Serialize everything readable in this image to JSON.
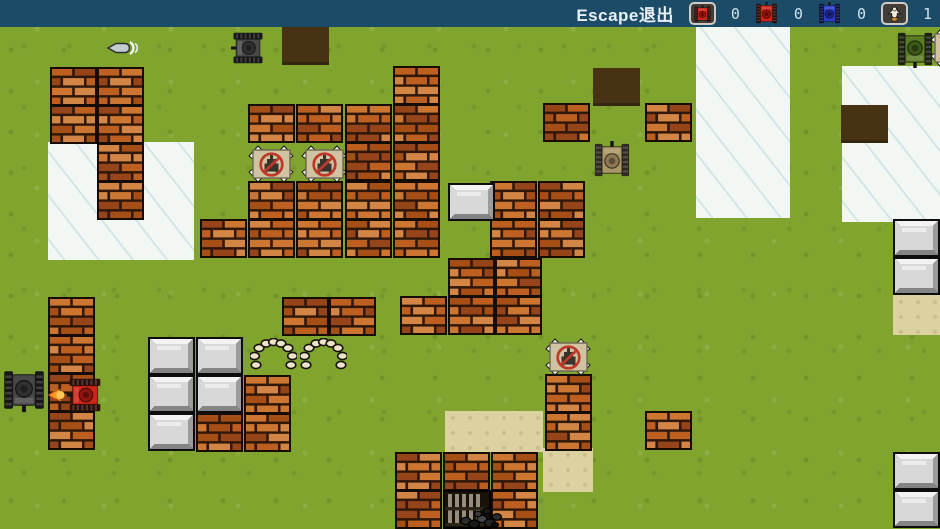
{
  "hud": {
    "escape_label": "Escape退出",
    "counts": [
      "0",
      "0",
      "0",
      "1"
    ],
    "icons": [
      "player-red-tank-icon",
      "red-tank-icon",
      "blue-tank-icon",
      "base-eagle-icon"
    ],
    "colors": {
      "bar": "#1c4b68",
      "text": "#e9f0f5",
      "count": "#cfe3f0"
    }
  },
  "map": {
    "tile_size": {
      "w": 47,
      "h": 39
    },
    "colors": {
      "grass": "#81a42f",
      "ice": "#f3f7f4",
      "hole": "#473314",
      "sand": "#dcd1a1",
      "brick": {
        "palette": [
          "#bd5f20",
          "#cc7631",
          "#a54e15",
          "#d28544",
          "#964419"
        ],
        "mortar": "#2f180a",
        "border": "#150d05"
      },
      "steel": {
        "light": "#f3f3f3",
        "mid": "#d8d8d8",
        "dark": "#9c9c9c",
        "darker": "#848484",
        "border": "#0d0d0d"
      },
      "sign": {
        "board": "#cfc3a1",
        "ring": "#bf392b",
        "glyph": "#3a332b"
      },
      "tanks": {
        "dark": {
          "hull": "#474747",
          "track": "#171717",
          "turret": "#303030"
        },
        "red": {
          "hull": "#cf2418",
          "track": "#2b0e08",
          "turret": "#8f150d"
        },
        "tan": {
          "hull": "#ab9668",
          "track": "#2e2a21",
          "turret": "#8c7852"
        },
        "green": {
          "hull": "#5b7a24",
          "track": "#1c2410",
          "turret": "#3e5717"
        },
        "blue": {
          "hull": "#2a3bc9",
          "track": "#0d123a",
          "turret": "#1b2588"
        }
      }
    },
    "ground": {
      "ice_rects": [
        {
          "x": 48,
          "y": 142,
          "w": 146,
          "h": 118
        },
        {
          "x": 696,
          "y": 27,
          "w": 94,
          "h": 191
        },
        {
          "x": 842,
          "y": 66,
          "w": 98,
          "h": 156
        }
      ],
      "sand_rects": [
        {
          "x": 445,
          "y": 411,
          "w": 98,
          "h": 41
        },
        {
          "x": 543,
          "y": 448,
          "w": 50,
          "h": 44
        },
        {
          "x": 893,
          "y": 295,
          "w": 47,
          "h": 40
        }
      ],
      "holes": [
        [
          282,
          27
        ],
        [
          593,
          68
        ],
        [
          841,
          105
        ]
      ]
    },
    "bricks": [
      [
        50,
        67
      ],
      [
        97,
        67
      ],
      [
        50,
        105
      ],
      [
        97,
        105
      ],
      [
        97,
        143
      ],
      [
        97,
        181
      ],
      [
        48,
        297
      ],
      [
        48,
        335
      ],
      [
        48,
        373
      ],
      [
        48,
        411
      ],
      [
        282,
        297
      ],
      [
        329,
        297
      ],
      [
        393,
        66
      ],
      [
        248,
        104
      ],
      [
        296,
        104
      ],
      [
        345,
        104
      ],
      [
        393,
        104
      ],
      [
        345,
        142
      ],
      [
        393,
        142
      ],
      [
        248,
        181
      ],
      [
        296,
        181
      ],
      [
        345,
        181
      ],
      [
        393,
        181
      ],
      [
        200,
        219
      ],
      [
        248,
        219
      ],
      [
        296,
        219
      ],
      [
        345,
        219
      ],
      [
        393,
        219
      ],
      [
        490,
        181
      ],
      [
        538,
        181
      ],
      [
        490,
        219
      ],
      [
        538,
        219
      ],
      [
        448,
        258
      ],
      [
        495,
        258
      ],
      [
        400,
        296
      ],
      [
        448,
        296
      ],
      [
        495,
        296
      ],
      [
        543,
        103
      ],
      [
        645,
        103
      ],
      [
        545,
        374
      ],
      [
        545,
        412
      ],
      [
        645,
        411
      ],
      [
        395,
        452
      ],
      [
        443,
        452
      ],
      [
        491,
        452
      ],
      [
        395,
        490
      ],
      [
        491,
        490
      ],
      [
        196,
        413
      ],
      [
        244,
        375
      ],
      [
        244,
        413
      ]
    ],
    "steel": [
      [
        448,
        183
      ],
      [
        148,
        337
      ],
      [
        196,
        337
      ],
      [
        148,
        375
      ],
      [
        196,
        375
      ],
      [
        148,
        413
      ],
      [
        893,
        219
      ],
      [
        893,
        257
      ],
      [
        893,
        452
      ],
      [
        893,
        490
      ]
    ],
    "signs": [
      [
        248,
        144
      ],
      [
        301,
        144
      ],
      [
        545,
        337
      ],
      [
        930,
        28
      ]
    ],
    "stones": [
      [
        250,
        338
      ],
      [
        300,
        338
      ]
    ],
    "gates": [
      [
        443,
        490
      ]
    ],
    "rubble": [
      [
        459,
        502
      ]
    ],
    "tanks": [
      {
        "id": "enemy-dark-tank-top",
        "color": "dark",
        "x": 226,
        "y": 31,
        "w": 44,
        "h": 34,
        "facing": "left"
      },
      {
        "id": "enemy-dark-tank-left",
        "color": "dark",
        "x": -2,
        "y": 368,
        "w": 52,
        "h": 44,
        "facing": "down"
      },
      {
        "id": "player-red-tank",
        "color": "red",
        "x": 62,
        "y": 377,
        "w": 46,
        "h": 36,
        "facing": "left",
        "firing": true
      },
      {
        "id": "enemy-tan-tank",
        "color": "tan",
        "x": 592,
        "y": 141,
        "w": 40,
        "h": 38,
        "facing": "up"
      },
      {
        "id": "enemy-green-tank",
        "color": "green",
        "x": 896,
        "y": 30,
        "w": 38,
        "h": 38,
        "facing": "down"
      }
    ],
    "bullets": [
      {
        "x": 105,
        "y": 40,
        "dir": "left"
      }
    ]
  }
}
